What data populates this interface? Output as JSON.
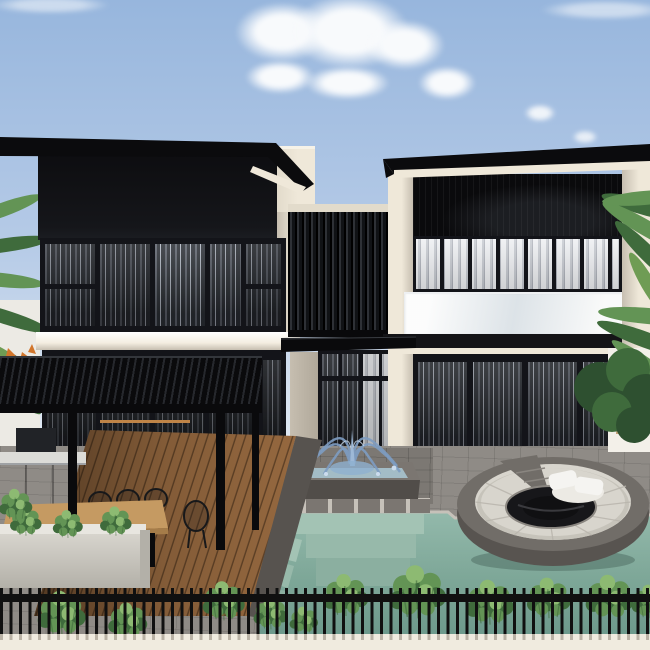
{
  "scene": {
    "type": "3d-architectural-exterior-rendering",
    "title": "Modern two-volume villa with black slatted facades, glass balcony, pergola dining terrace, fountain, swimming pool and sunken circular lounge",
    "objects": {
      "sky": {
        "label": "clear blue sky with scattered white cumulus clouds"
      },
      "palm_left": {
        "label": "palm fronds at left edge behind the house"
      },
      "palm_right": {
        "label": "palm tree with tan trunk and dark shrubs at right side"
      },
      "left_building": {
        "label": "left volume: black upper facade, curtained window wall, white floor slab"
      },
      "right_building": {
        "label": "right volume: black slat screen, white-curtain windows, glass balustrade balcony"
      },
      "privacy_screen": {
        "label": "dark vertical-slat privacy screen linking the two volumes"
      },
      "awning": {
        "label": "black canopy slab over the central patio doors"
      },
      "patio_doors": {
        "label": "central glass patio doors with gray curtains"
      },
      "pergola": {
        "label": "black slatted pergola over the dining deck"
      },
      "outdoor_kitchen": {
        "label": "gray outdoor kitchen counter at far left"
      },
      "dining_set": {
        "label": "wooden dining table with black wire chairs"
      },
      "planter": {
        "label": "concrete planter box with green plants"
      },
      "deck": {
        "label": "diagonal wooden plank deck"
      },
      "fountain": {
        "label": "square stone fountain with arcing water jets"
      },
      "pool": {
        "label": "teal swimming pool with underwater stone steps"
      },
      "sunken_lounge": {
        "label": "sunken circular lounge with gray cushions, white pillows and fire pit"
      },
      "patio": {
        "label": "gray stone paver patio"
      },
      "shrubs": {
        "label": "row of green shrubs along the pool fence"
      },
      "fence": {
        "label": "black metal picket fence"
      },
      "perimeter_wall": {
        "label": "cream perimeter wall at the bottom"
      }
    }
  },
  "palette": {
    "sky_top": "#97b6dd",
    "sky_mid": "#b6cbe7",
    "sky_low": "#d9e4f1",
    "haze": "#eef2f7",
    "cloud_white": "#f8fafc",
    "roof_dark": "#0b0b0d",
    "facade_dark": "#0d0d10",
    "frame_dark": "#131419",
    "cream_lit": "#efe8d9",
    "cream_mid": "#e2dbcb",
    "cream_shade": "#c6beb0",
    "slab_white": "#f4eee1",
    "curtain_a": "#4a4e56",
    "curtain_b": "#24272c",
    "curtain_hi": "#8a8f98",
    "curtain_lt_a": "#eceef1",
    "curtain_lt_b": "#c2c6cd",
    "curtain_lt_c": "#a9adb6",
    "balustrade": "#e9eef3",
    "balcony_bg": "#e9e6e0",
    "screen_a": "#101215",
    "screen_b": "#2e3136",
    "pergola_dark": "#0a0a0c",
    "pergola_gap": "#26282d",
    "wood_plank": "#95683f",
    "wood_gap": "#5f4126",
    "wood_table": "#c59a62",
    "wood_rod": "#bf8447",
    "deck_border": "#57534f",
    "paver_base": "#8f8b86",
    "paver_dark": "#7c7873",
    "paver_gap": "#b8b3ac",
    "counter_body": "#6b6e72",
    "counter_top": "#dcdcd8",
    "appliance": "#212327",
    "planter_lit": "#d7d4cd",
    "planter_rim": "#e8e6e0",
    "planter_shade": "#b3b0a8",
    "basin_stone": "#7b7671",
    "basin_front": "#514d49",
    "basin_water": "#a3bcc6",
    "jet_blue": "#7d9cc2",
    "jet_light": "#ccdcee",
    "pool_a": "#93b9ab",
    "pool_b": "#7fa899",
    "pool_deep": "#6d998b",
    "step_t1": "#a3c3b4",
    "step_t2": "#97b9aa",
    "step_t3": "#8bafa0",
    "coping": "#c6c1b9",
    "lounge_wall": "#585450",
    "lounge_stone": "#716d68",
    "cushion": "#d8d5cd",
    "cushion_shade": "#c6c3ba",
    "pillow": "#f5f4f1",
    "pit_dark": "#17171a",
    "bush_dark": "#3f6b3c",
    "bush_mid": "#639455",
    "bush_light": "#8dba72",
    "bush_deep": "#2e5030",
    "grass": "#6f9c54",
    "trunk_tan": "#c3a077",
    "flower_orange": "#d2762b",
    "fence_black": "#101010",
    "wall_cream": "#f0ebdf"
  }
}
